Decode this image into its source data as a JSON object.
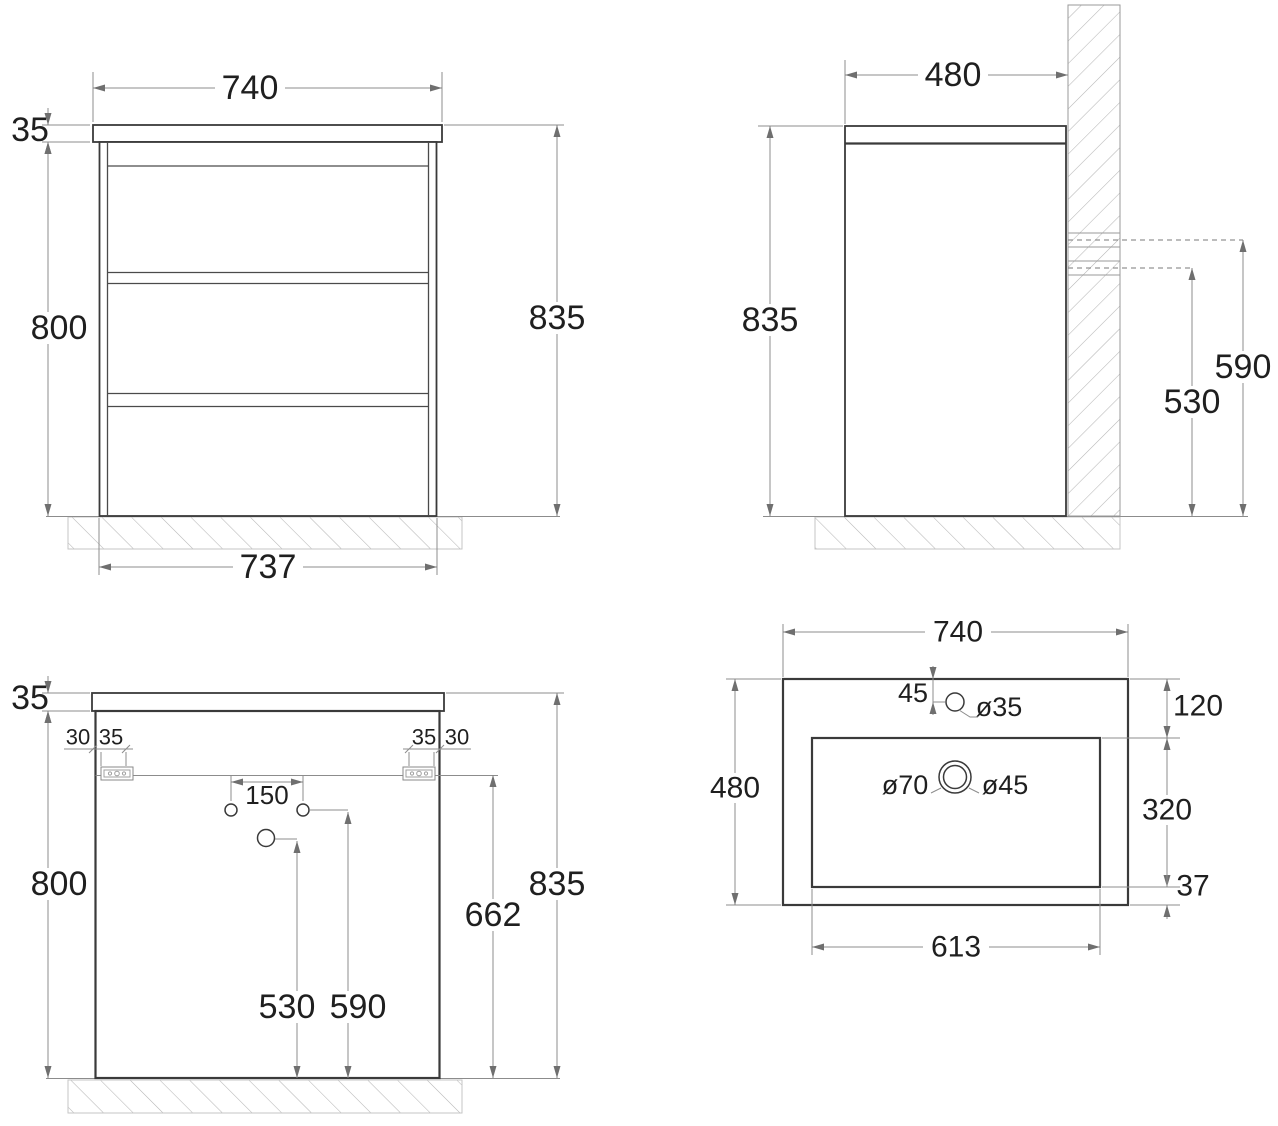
{
  "drawing": {
    "front_view": {
      "width_top": "740",
      "countertop_thickness": "35",
      "body_height": "800",
      "total_height": "835",
      "width_bottom": "737"
    },
    "side_view": {
      "depth": "480",
      "total_height": "835",
      "drain_hole_height": "530",
      "supply_hole_height": "590"
    },
    "back_view": {
      "countertop_thickness": "35",
      "bracket_offset_left": "30",
      "bracket_width_left": "35",
      "bracket_width_right": "35",
      "bracket_offset_right": "30",
      "hole_spacing": "150",
      "body_height": "800",
      "drain_hole_height": "530",
      "supply_hole_height": "590",
      "bracket_height": "662",
      "total_height": "835"
    },
    "top_view": {
      "width": "740",
      "depth": "480",
      "faucet_offset": "45",
      "faucet_hole_diameter": "ø35",
      "drain_outer_diameter": "ø70",
      "drain_hole_diameter": "ø45",
      "basin_width": "613",
      "basin_depth": "320",
      "basin_back_offset": "120",
      "basin_front_offset": "37"
    }
  }
}
